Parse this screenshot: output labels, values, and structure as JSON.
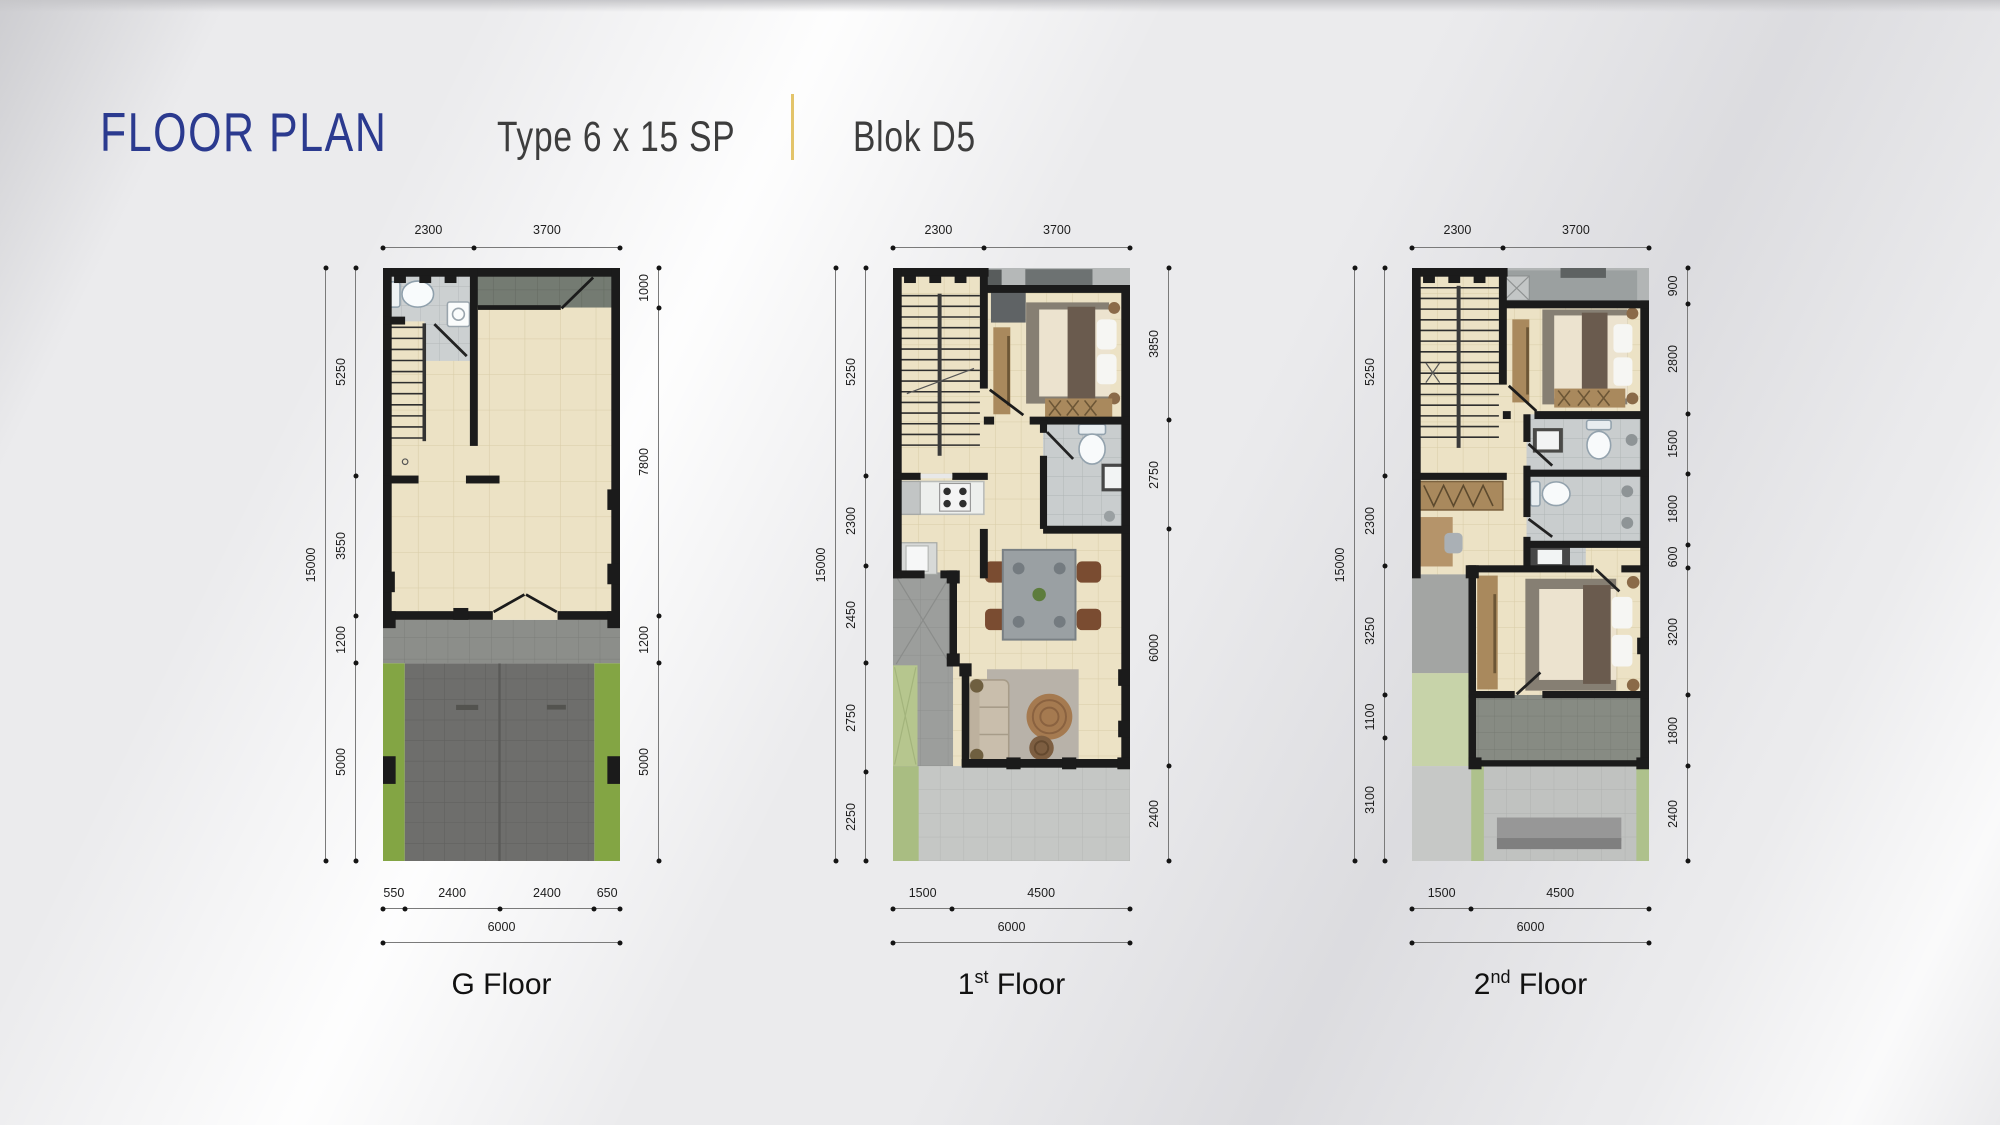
{
  "header": {
    "title": "FLOOR PLAN",
    "subtitle": "Type 6 x 15 SP",
    "block": "Blok D5",
    "title_color": "#2b3a8f",
    "divider_color": "#e3c46a"
  },
  "plans": [
    {
      "id": "g-floor",
      "label": {
        "pre": "G",
        "sup": "",
        "post": " Floor"
      },
      "dims_top": [
        "2300",
        "3700"
      ],
      "dims_left_overall": "15000",
      "dims_left": [
        "5250",
        "3550",
        "1200",
        "5000"
      ],
      "dims_right": [
        "1000",
        "7800",
        "1200",
        "5000"
      ],
      "dims_bottom": [
        "550",
        "2400",
        "2400",
        "650"
      ],
      "dims_bottom_overall": "6000"
    },
    {
      "id": "first-floor",
      "label": {
        "pre": "1",
        "sup": "st",
        "post": " Floor"
      },
      "dims_top": [
        "2300",
        "3700"
      ],
      "dims_left_overall": "15000",
      "dims_left": [
        "5250",
        "2300",
        "2450",
        "2750",
        "2250"
      ],
      "dims_right": [
        "3850",
        "2750",
        "6000",
        "2400"
      ],
      "dims_bottom": [
        "1500",
        "4500"
      ],
      "dims_bottom_overall": "6000"
    },
    {
      "id": "second-floor",
      "label": {
        "pre": "2",
        "sup": "nd",
        "post": " Floor"
      },
      "dims_top": [
        "2300",
        "3700"
      ],
      "dims_left_overall": "15000",
      "dims_left": [
        "5250",
        "2300",
        "3250",
        "1100",
        "3100"
      ],
      "dims_right": [
        "900",
        "2800",
        "1500",
        "1800",
        "600",
        "3200",
        "1800",
        "2400"
      ],
      "dims_bottom": [
        "1500",
        "4500"
      ],
      "dims_bottom_overall": "6000"
    }
  ]
}
